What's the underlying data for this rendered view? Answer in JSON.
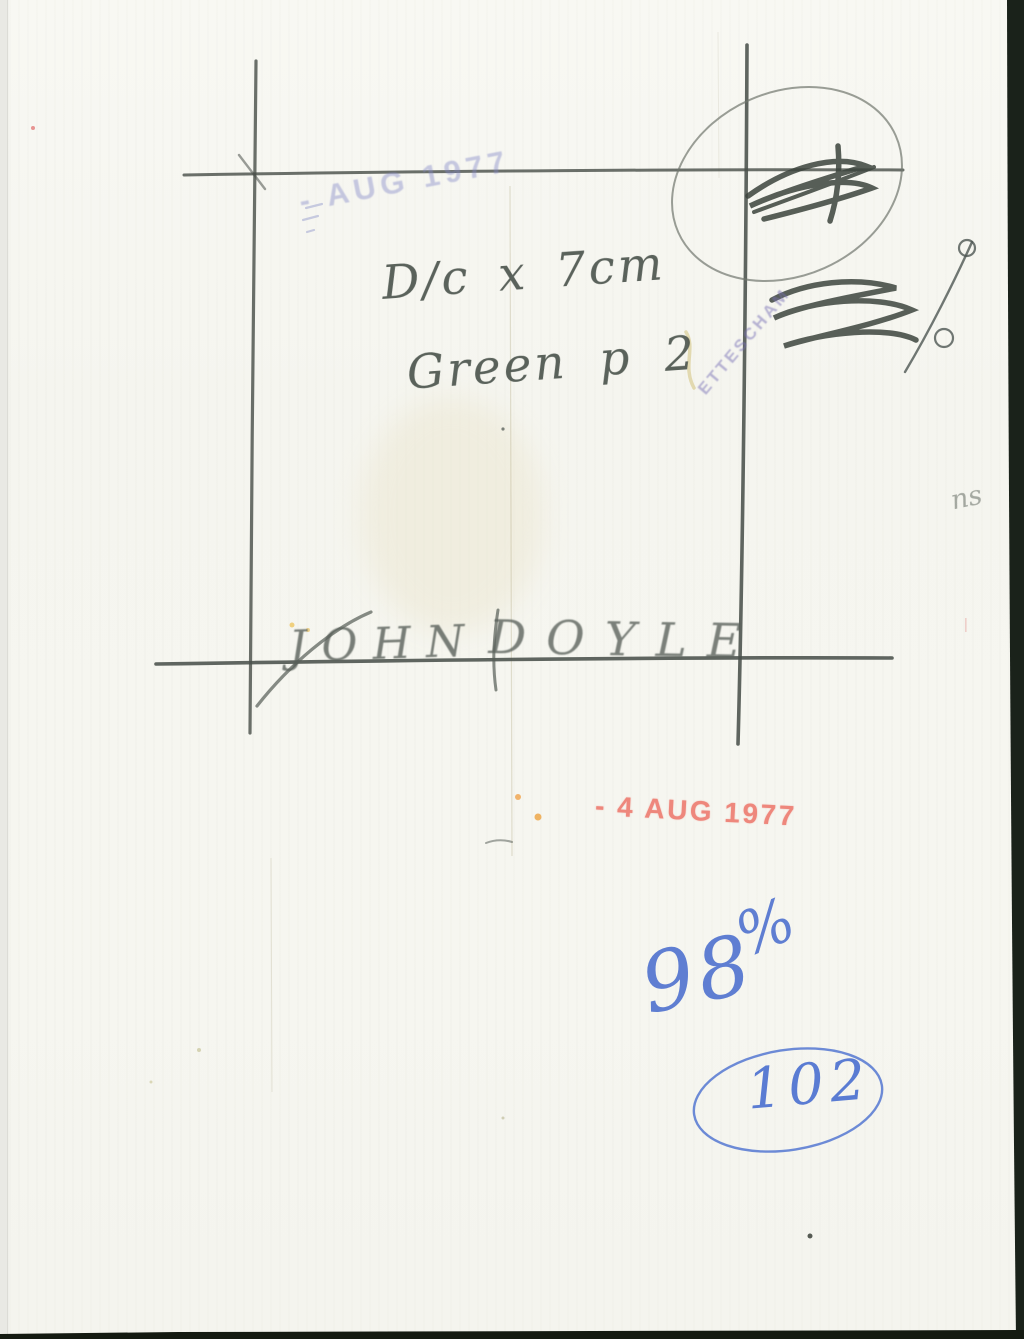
{
  "page": {
    "description": "Scanned verso of a press photograph with handwritten crop marks, notes and date stamps"
  },
  "handwriting": {
    "dimension_note": "D/c x 7cm",
    "color_note": "Green p 2",
    "signature_first": "JOHN",
    "signature_last": "DOYLE"
  },
  "stamps": {
    "faint_blue_date": "- AUG 1977",
    "red_date": "- 4 AUG 1977",
    "diagonal_agency": "ETTESCHAM"
  },
  "pen_notes": {
    "number": "98",
    "percent": "%",
    "circled_number": "102"
  },
  "pencil_fragments": {
    "edge_text": "ns"
  },
  "marks": {
    "top_right_circled_scribble": "illegible crossed-out pencil scribble inside pencil oval",
    "percent_like_scribble": "illegible pencil scribble with percent-style circles and slash"
  },
  "colors": {
    "paper": "#f5f5ef",
    "pencil": "#4a514b",
    "red_stamp": "#ee7e73",
    "blue_pen": "#4f72cf",
    "faint_stamp_blue": "#8086c6",
    "scan_edge_dark": "#1a221a"
  }
}
